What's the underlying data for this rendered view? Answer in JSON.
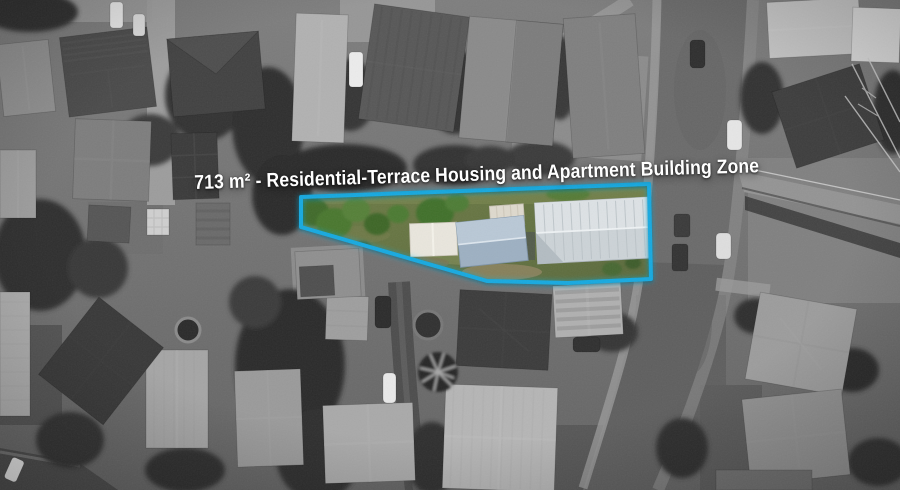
{
  "overlay": {
    "label": "713 m² - Residential-Terrace Housing and Apartment Building Zone"
  },
  "property": {
    "area": "713 m²",
    "zone_name": "Residential-Terrace Housing and Apartment Building Zone",
    "outline_color": "#14a9e0"
  }
}
